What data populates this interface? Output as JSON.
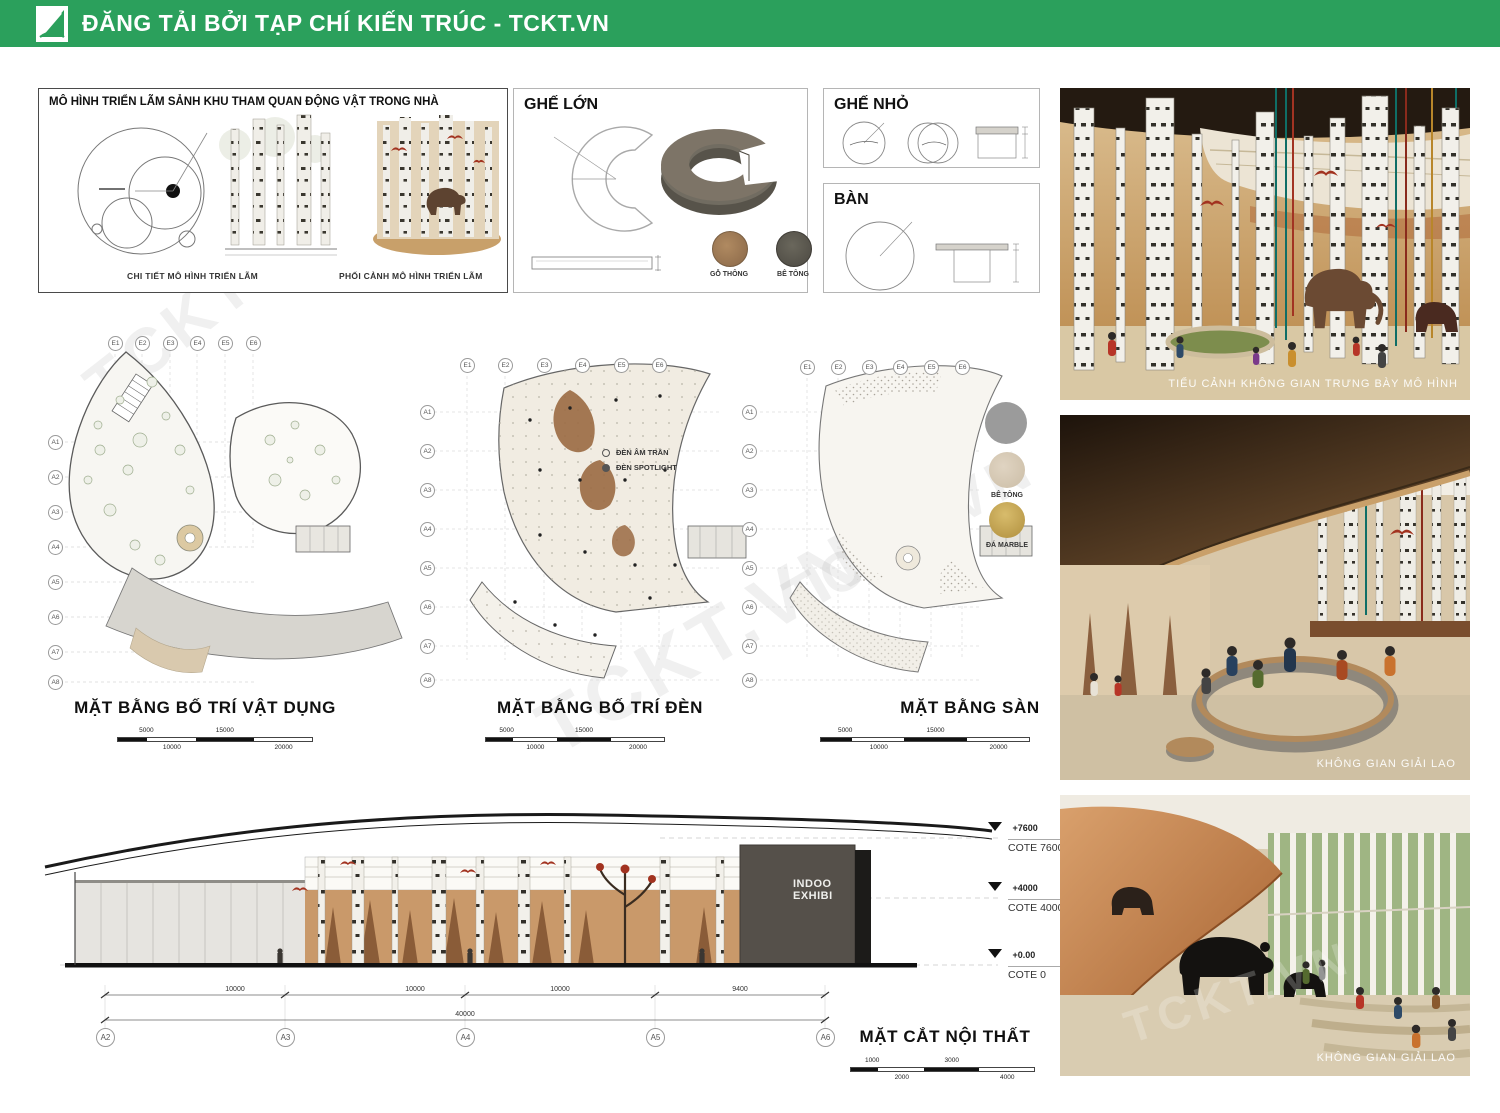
{
  "watermark": "TCKT.VN",
  "header": {
    "title": "ĐĂNG TẢI BỞI TẠP CHÍ KIẾN TRÚC - TCKT.VN",
    "brand_color": "#2ba05c"
  },
  "model_box": {
    "title": "MÔ HÌNH TRIỂN LÃM SẢNH KHU THAM QUAN ĐỘNG VẬT TRONG NHÀ",
    "caption_detail": "CHI TIẾT MÔ HÌNH TRIỂN LÃM",
    "caption_perspective": "PHỐI CẢNH MÔ HÌNH TRIỂN LÃM"
  },
  "furniture": {
    "large_seat_title": "GHẾ LỚN",
    "small_seat_title": "GHẾ NHỎ",
    "table_title": "BÀN",
    "materials": [
      {
        "label": "GỖ THÔNG",
        "color": "#a0795a"
      },
      {
        "label": "BÊ TÔNG",
        "color": "#5c594f"
      }
    ]
  },
  "grid": {
    "cols": [
      "E1",
      "E2",
      "E3",
      "E4",
      "E5",
      "E6"
    ],
    "rows": [
      "A1",
      "A2",
      "A3",
      "A4",
      "A5",
      "A6",
      "A7",
      "A8"
    ]
  },
  "plan_scale": {
    "top": [
      "5000",
      "15000"
    ],
    "bottom": [
      "10000",
      "20000"
    ]
  },
  "plans": [
    {
      "title": "MẶT BẰNG BỐ TRÍ VẬT DỤNG"
    },
    {
      "title": "MẶT BẰNG BỐ TRÍ ĐÈN",
      "legend": [
        {
          "label": "ĐÈN ÂM TRẦN"
        },
        {
          "label": "ĐÈN SPOTLIGHT"
        }
      ]
    },
    {
      "title": "MẶT BẰNG SÀN",
      "materials": [
        {
          "label": "",
          "color": "#9b9b9b"
        },
        {
          "label": "BÊ TÔNG",
          "color": "#d8cab6"
        },
        {
          "label": "ĐÁ MARBLE",
          "color": "#c2a14f"
        }
      ]
    }
  ],
  "section": {
    "title": "MẶT CẮT NỘI THẤT",
    "scale_top": [
      "1000",
      "3000"
    ],
    "scale_bottom": [
      "2000",
      "4000"
    ],
    "levels": [
      {
        "value": "+7600",
        "cote": "COTE 7600"
      },
      {
        "value": "+4000",
        "cote": "COTE 4000"
      },
      {
        "value": "+0.00",
        "cote": "COTE 0"
      }
    ],
    "wall_text": [
      "INDOO",
      "EXHIBI"
    ],
    "grid_bubbles": [
      "A2",
      "A3",
      "A4",
      "A5",
      "A6"
    ],
    "dims": [
      "10000",
      "10000",
      "10000",
      "9400"
    ],
    "total_dim": "40000"
  },
  "renders": [
    {
      "caption": "TIỂU CẢNH KHÔNG GIAN TRƯNG BÀY MÔ HÌNH"
    },
    {
      "caption": "KHÔNG GIAN GIẢI LAO"
    },
    {
      "caption": "KHÔNG GIAN GIẢI LAO"
    }
  ]
}
